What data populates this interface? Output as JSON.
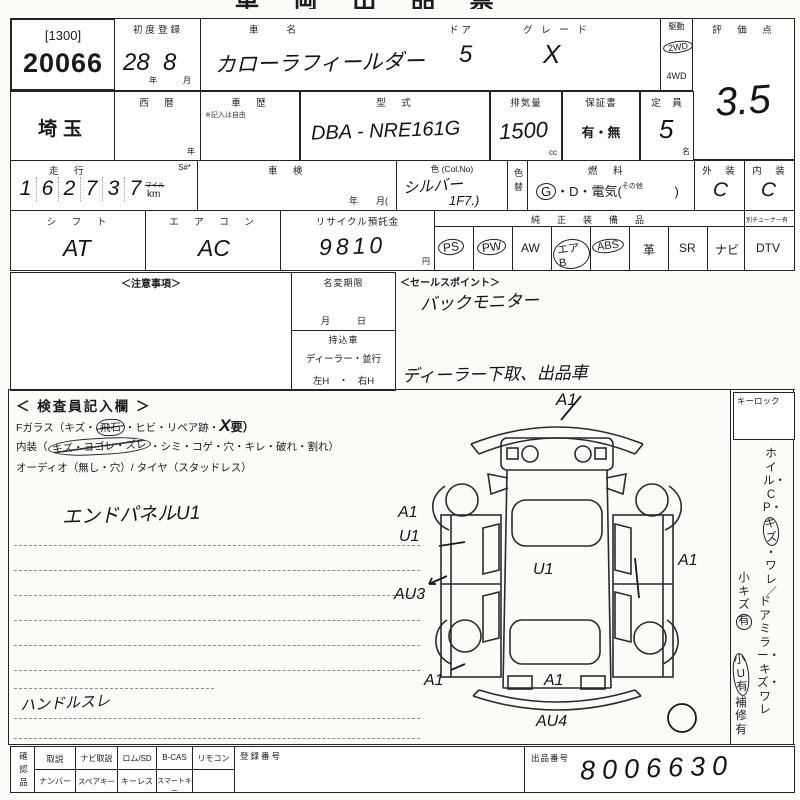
{
  "title": {
    "clipped": "車 両 出 品 票"
  },
  "lot": {
    "code": "[1300]",
    "number": "20066"
  },
  "header": {
    "first_reg": {
      "label": "初度登録",
      "year": "28",
      "year_unit": "年",
      "month": "8",
      "month_unit": "月"
    },
    "car_name": {
      "label": "車　　名",
      "value": "カローラフィールダー"
    },
    "door": {
      "label": "ドア",
      "value": "5"
    },
    "grade": {
      "label": "グ レ ー ド",
      "value": "X"
    },
    "drive": {
      "label": "駆動",
      "twd": "2WD",
      "fwd": "4WD",
      "twd_circled": true
    },
    "score": {
      "label": "評　価　点",
      "value": "3.5"
    },
    "prefecture": {
      "value": "埼玉"
    },
    "seireki": {
      "label": "西　暦",
      "unit": "年"
    },
    "shareki": {
      "label": "車　歴",
      "note": "※記入は自由"
    },
    "model_code": {
      "label": "型　式",
      "value": "DBA - NRE161G"
    },
    "displacement": {
      "label": "排気量",
      "value": "1500",
      "unit": "cc"
    },
    "warranty": {
      "label": "保証書",
      "value": "有・無"
    },
    "capacity": {
      "label": "定　員",
      "value": "5",
      "unit": "名"
    },
    "mileage": {
      "label": "走　行",
      "digits": [
        "1",
        "6",
        "2",
        "7",
        "3",
        "7"
      ],
      "unit_top": "マイル",
      "unit_bottom": "km",
      "s_label": "S#*"
    },
    "inspection": {
      "label": "車　検",
      "unit": "年　　月("
    },
    "color": {
      "label": "色 (Col.No)",
      "value": "シルバー",
      "code": "1F7.)"
    },
    "color_change": {
      "label": "色替"
    },
    "fuel": {
      "label": "燃　料",
      "gas": "G",
      "gas_circled": true,
      "rest": "・D・電気(",
      "other": "その他",
      "close": ")"
    },
    "exterior": {
      "label": "外　装",
      "value": "C"
    },
    "interior": {
      "label": "内　装",
      "value": "C"
    },
    "shift": {
      "label": "シ　フ　ト",
      "value": "AT"
    },
    "aircon": {
      "label": "エ　ア　コ　ン",
      "value": "AC"
    },
    "recycle": {
      "label": "リサイクル預託金",
      "value": "9810",
      "unit": "円"
    },
    "equipment": {
      "label": "純　正　装　備　品",
      "items": [
        {
          "label": "PS",
          "circled": true
        },
        {
          "label": "PW",
          "circled": true
        },
        {
          "label": "AW",
          "circled": false
        },
        {
          "label": "エアB",
          "circled": true
        },
        {
          "label": "ABS",
          "circled": true
        },
        {
          "label": "革",
          "circled": false
        },
        {
          "label": "SR",
          "circled": false
        },
        {
          "label": "ナビ",
          "circled": false
        }
      ],
      "tuner_note": "別チューナー有",
      "dtv": "DTV"
    }
  },
  "middle": {
    "notes": {
      "header": "＜注意事項＞"
    },
    "name_change": {
      "label": "名変期限",
      "fields": "月　　　日"
    },
    "bring_in": {
      "label": "持込車",
      "line1": "ディーラー・並行",
      "line2": "左H　・　右H"
    },
    "sales_point": {
      "header": "＜セールスポイント＞",
      "value": "バックモニター",
      "note": "ディーラー下取、出品車"
    }
  },
  "inspector": {
    "header": "＜ 検査員記入欄 ＞",
    "f_glass": {
      "pre": "Fガラス（キズ・",
      "circled": "飛石",
      "mid": "・ヒビ・リペア跡・",
      "x": "X",
      "post": "要）"
    },
    "interior_line": {
      "pre": "内装（",
      "scribbled": "キズ・ヨゴレ・ズレ",
      "post": "・シミ・コゲ・穴・キレ・破れ・割れ）"
    },
    "audio_line": "オーディオ（無し・穴）/ タイヤ（スタッドレス）",
    "note1": "エンドパネルU1",
    "note2": "ハンドルスレ"
  },
  "right_col": {
    "keylock": "キーロック",
    "wheel": {
      "pre": "ホイル・CP・",
      "circled": "キズ",
      "post": "・ワレ／"
    },
    "wheel2": {
      "pre": "小キズ",
      "circled": "有"
    },
    "mirror": "ドアミラー・キズ・ワレ",
    "mirror2": {
      "circled": "小U有",
      "post": "補修有"
    }
  },
  "diagram": {
    "marks": [
      {
        "label": "A1"
      },
      {
        "label": "A1"
      },
      {
        "label": "U1"
      },
      {
        "label": "AU3"
      },
      {
        "label": "U1"
      },
      {
        "label": "A1"
      },
      {
        "label": "A1"
      },
      {
        "label": "A1"
      },
      {
        "label": "AU4"
      }
    ]
  },
  "bottom": {
    "side_label": "確認品",
    "row1": [
      "取説",
      "ナビ取説",
      "ロム/SD",
      "B-CAS",
      "リモコン"
    ],
    "row2": [
      "ナンバー",
      "スペアキー",
      "キーレス",
      "スマートキー"
    ],
    "reg_label": "登録番号",
    "lot_label": "出品番号",
    "lot_value": "8006630"
  }
}
